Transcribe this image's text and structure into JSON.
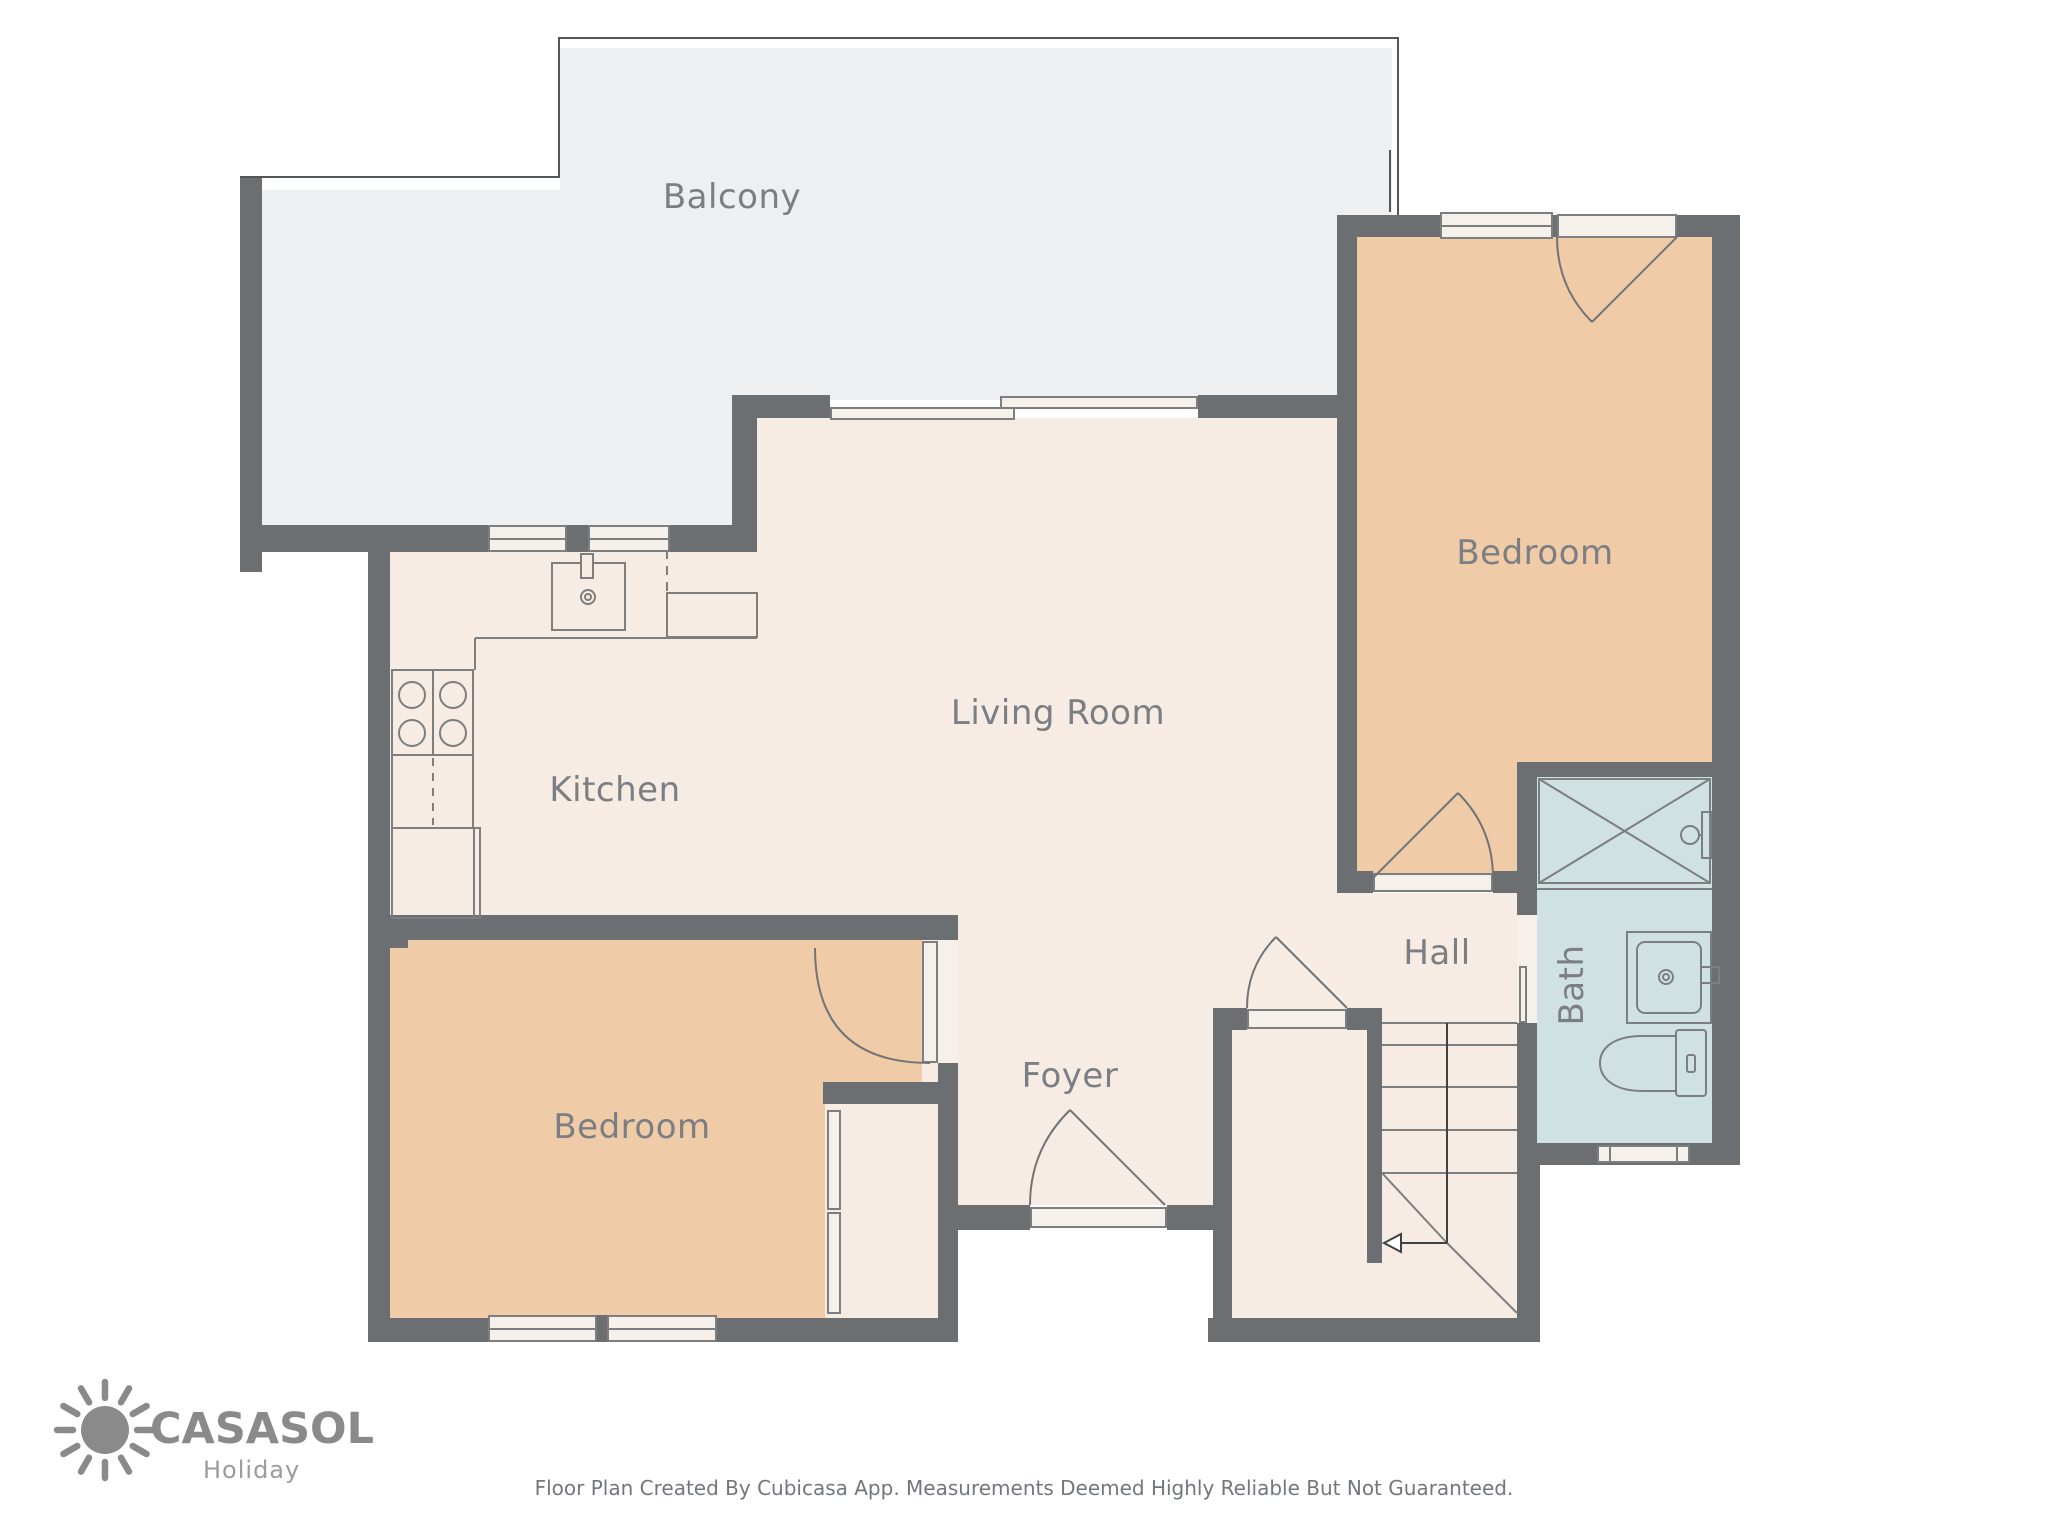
{
  "rooms": {
    "balcony": {
      "label": "Balcony"
    },
    "bedroom_top_right": {
      "label": "Bedroom"
    },
    "living_room": {
      "label": "Living Room"
    },
    "kitchen": {
      "label": "Kitchen"
    },
    "bedroom_bottom_left": {
      "label": "Bedroom"
    },
    "foyer": {
      "label": "Foyer"
    },
    "hall": {
      "label": "Hall"
    },
    "bath": {
      "label": "Bath"
    }
  },
  "branding": {
    "name": "CASASOL",
    "tagline": "Holiday"
  },
  "footer": {
    "disclaimer": "Floor Plan Created By Cubicasa App. Measurements Deemed Highly Reliable But Not Guaranteed."
  },
  "colors": {
    "wall": "#6c6f72",
    "floor_main": "#f7ece4",
    "floor_bedroom": "#f0cba7",
    "floor_bath": "#d0e1e3",
    "floor_balcony": "#edeff0",
    "label": "#7b7e82",
    "logo": "#8a8a8a"
  }
}
